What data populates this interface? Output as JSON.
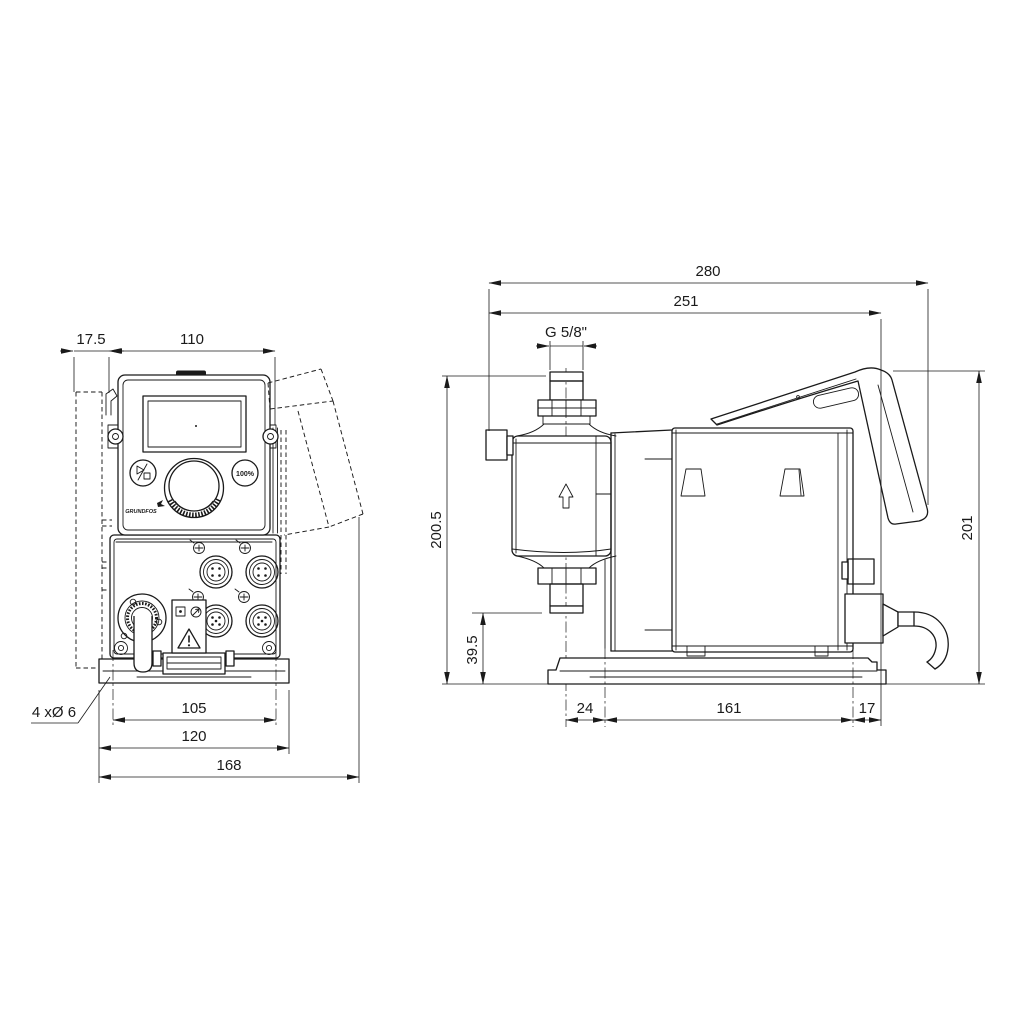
{
  "drawing": {
    "type": "dosing-pump dimensional drawing, front and side views, dimensions in mm",
    "colors": {
      "line": "#1a1a1a",
      "background": "#ffffff"
    },
    "front_view": {
      "dimensions": {
        "bracket_offset": "17.5",
        "width": "110",
        "mounting_holes": "4 xØ 6",
        "hole_spacing": "105",
        "base_width": "120",
        "overall_width": "168"
      },
      "control_panel": {
        "logo": "GRUNDFOS",
        "max_capacity_button": "100%"
      }
    },
    "side_view": {
      "dimensions": {
        "overall_depth": "280",
        "depth_without_cover": "251",
        "connection_thread": "G 5/8\"",
        "height_to_connection": "200.5",
        "height_to_valve": "39.5",
        "base_front_offset": "24",
        "base_length": "161",
        "base_rear_offset": "17",
        "overall_height": "201"
      }
    }
  }
}
